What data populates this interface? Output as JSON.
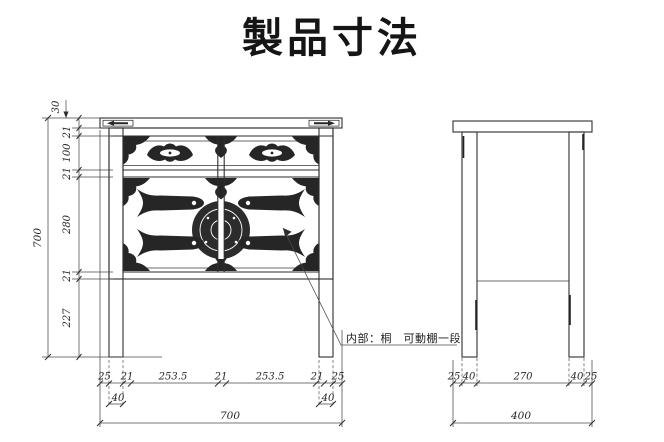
{
  "title": "製品寸法",
  "annotation": "内部：桐　可動棚一段",
  "colors": {
    "line": "#2e2e2e",
    "ink": "#151515",
    "background": "#ffffff"
  },
  "front_view": {
    "total_height": "700",
    "top_board_thickness": "30",
    "height_chain": [
      "21",
      "100",
      "21",
      "280",
      "21",
      "227"
    ],
    "width_chain": [
      "25",
      "21",
      "253.5",
      "21",
      "253.5",
      "21",
      "25"
    ],
    "left_leg_width": "40",
    "right_leg_width": "40",
    "total_width": "700"
  },
  "side_view": {
    "width_chain": [
      "25",
      "40",
      "270",
      "40",
      "25"
    ],
    "total_width": "400"
  }
}
